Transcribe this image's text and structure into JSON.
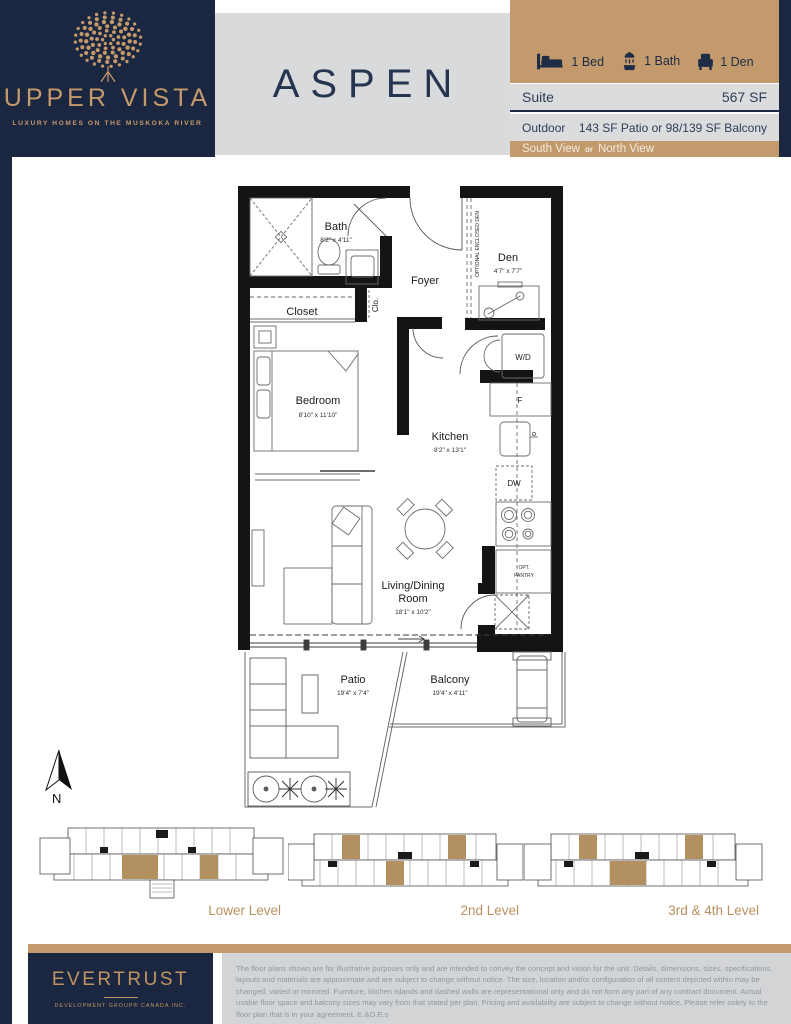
{
  "header": {
    "brand_name": "UPPER VISTA",
    "brand_tagline": "LUXURY HOMES ON THE MUSKOKA RIVER",
    "plan_name": "ASPEN",
    "features": [
      {
        "label": "1 Bed"
      },
      {
        "label": "1 Bath"
      },
      {
        "label": "1 Den"
      }
    ],
    "suite_label": "Suite",
    "suite_value": "567 SF",
    "outdoor_label": "Outdoor",
    "outdoor_value": "143 SF Patio or 98/139 SF Balcony",
    "view_first": "South View",
    "view_conj": "or",
    "view_second": "North View"
  },
  "floorplan": {
    "bath": {
      "name": "Bath",
      "dims": "8'2\" x 4'11\""
    },
    "foyer": {
      "name": "Foyer"
    },
    "den": {
      "name": "Den",
      "dims": "4'7\" x 7'7\""
    },
    "optional_den_note": "OPTIONAL ENCLOSED DEN",
    "closet": {
      "name": "Closet"
    },
    "clo": {
      "name": "Clo."
    },
    "bedroom": {
      "name": "Bedroom",
      "dims": "8'10\" x 11'10\""
    },
    "kitchen": {
      "name": "Kitchen",
      "dims": "8'2\" x 13'1\""
    },
    "living": {
      "name_line1": "Living/Dining",
      "name_line2": "Room",
      "dims": "18'1\" x 10'2\""
    },
    "patio": {
      "name": "Patio",
      "dims": "19'4\" x 7'4\""
    },
    "balcony": {
      "name": "Balcony",
      "dims": "19'4\" x 4'11\""
    },
    "wd": "W/D",
    "fridge": "F",
    "dw": "DW",
    "pantry_line1": "OPT.",
    "pantry_line2": "PANTRY",
    "north": "N"
  },
  "levels": [
    {
      "label": "Lower Level"
    },
    {
      "label": "2nd Level"
    },
    {
      "label": "3rd & 4th Level"
    }
  ],
  "footer": {
    "developer_name": "EVERTRUST",
    "developer_sub": "DEVELOPMENT GROUP® CANADA INC.",
    "disclaimer": "The floor plans shown are for illustrative purposes only and are intended to convey the concept and vision for the unit. Details, dimensions, sizes, specifications, layouts and materials are approximate and are subject to change without notice. The size, location and/or configuration of all content depicted within may be changed, varied or mirrored. Furniture, kitchen islands and dashed walls are representational only and do not form any part of any contract document. Actual usable floor space and balcony sizes may vary from that stated per plan. Pricing and availability are subject to change without notice. Please refer solely to the floor plan that is in your agreement. E.&O.E.s"
  },
  "colors": {
    "navy": "#1b2740",
    "tan": "#c39a6b",
    "panel_gray": "#d8dadc",
    "disclaimer_gray": "#d2d4d6"
  }
}
